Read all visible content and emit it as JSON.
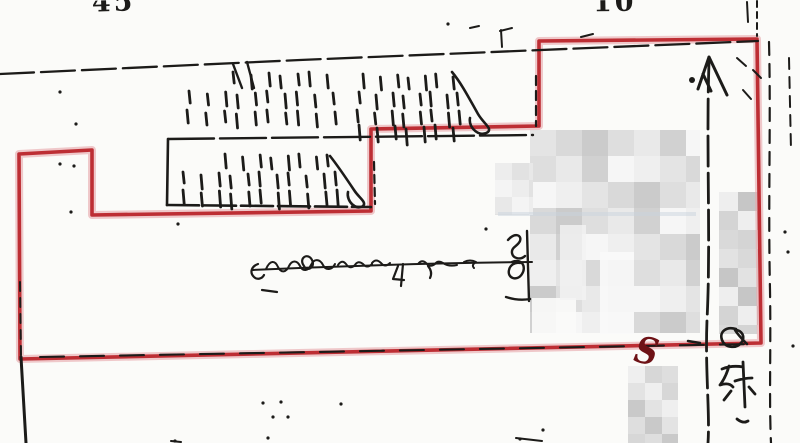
{
  "labels": {
    "top_left_partial": "45",
    "top_center_partial": "10",
    "boundary_s_mark": "S"
  },
  "colors": {
    "paper": "#fbfbf9",
    "ink": "#1c1b19",
    "boundary": "#b82127",
    "boundary_halo": "#e8a7aa",
    "annotation_red": "#6e1216"
  },
  "drawing": {
    "red_boundary": "19,154 92,150 92,215 371,211 371,129 539,126 539,41 757,39 761,343 20,359",
    "ink_lines": [
      {
        "pts": "0,74 300,60 758,41",
        "w": 2.3,
        "dash": "34 7",
        "n": "street-line-top"
      },
      {
        "pts": "168,139 533,135",
        "w": 2.4,
        "dash": "46 6",
        "n": "parcel-line"
      },
      {
        "pts": "168,139 167,205",
        "w": 2.6,
        "n": "parcel-line"
      },
      {
        "pts": "167,205 371,207",
        "w": 2.6,
        "dash": "32 5",
        "n": "parcel-line"
      },
      {
        "pts": "21,357 26,443",
        "w": 3,
        "n": "boundary-line-left-lower"
      },
      {
        "pts": "20,282 21,356",
        "w": 2,
        "dash": "9 7",
        "n": "ink-overlay"
      },
      {
        "pts": "40,357 752,344",
        "w": 2.1,
        "dash": "24 16",
        "n": "ink-overlay"
      },
      {
        "d": "M709,62 C706,150 711,240 707,320 C705,370 710,412 708,443",
        "w": 2.8,
        "dash": "30 7",
        "n": "road-line"
      },
      {
        "d": "M769,42 C771,120 768,200 770,290 C771,350 769,400 771,443",
        "w": 2.2,
        "dash": "13 9",
        "n": "road-line"
      },
      {
        "d": "M757,1 L757,36",
        "w": 2,
        "dash": "6 5",
        "n": "road-line"
      },
      {
        "d": "M747,2 L748,22",
        "w": 2,
        "n": "road-line"
      },
      {
        "d": "M789,58 L791,150",
        "w": 2,
        "dash": "11 8",
        "n": "road-line"
      },
      {
        "d": "M536,76 L536,126",
        "w": 2.2,
        "dash": "9 6",
        "n": "ink-overlay"
      },
      {
        "d": "M374,162 L375,204",
        "w": 2.2,
        "dash": "8 5",
        "n": "ink-overlay"
      },
      {
        "d": "M737,58 l9,8 M753,70 l8,8 M743,90 l8,9",
        "w": 2,
        "n": "scribble-marks"
      },
      {
        "d": "M688,341 l12,2",
        "w": 2.5,
        "n": "ink-overlay"
      },
      {
        "d": "M516,438 l26,3 M171,441 l10,1",
        "w": 2,
        "n": "edge-fragments"
      },
      {
        "d": "M500,31 l12,-3 M501,30 l1,17 M581,37 l12,-3 M470,28 l9,-2",
        "w": 2,
        "n": "tick-marks"
      }
    ],
    "paths": [
      {
        "d": "M709,57 L698,89 M709,57 L727,95 M703,74 L711,91",
        "w": 3,
        "n": "up-arrow-head"
      },
      {
        "d": "M252,270 C340,266 440,263 532,262",
        "w": 2,
        "n": "dimension-line"
      },
      {
        "d": "M258,264 c-6,2 -9,8 -4,13 c3,3 8,2 10,-2 M262,290 l15,2",
        "w": 2.2,
        "n": "dimension-left-tick"
      },
      {
        "d": "M266,269 c4,-9 9,-9 12,-2 c3,6 8,6 11,-1 c3,-6 8,-6 11,0 c3,6 8,5 11,-1 c3,-7 9,-6 12,0 c3,6 9,5 12,-1",
        "w": 2,
        "n": "dimension-text-scrawl"
      },
      {
        "d": "M304,266 c-6,-8 4,-14 8,-6 c4,8 -6,12 -8,6",
        "w": 2.2,
        "n": "dimension-text-scrawl"
      },
      {
        "d": "M338,265 q4,-6 8,-1 q4,6 9,1 q3,-5 8,-1 q4,5 9,0 M372,263 q4,-5 9,0 q4,5 9,0",
        "w": 2,
        "n": "dimension-text-scrawl"
      },
      {
        "d": "M398,266 l-5,13 l11,1 M403,264 l-2,22 M428,266 q5,6 2,12",
        "w": 2.2,
        "n": "dimension-text-scrawl"
      },
      {
        "d": "M418,264 q4,-5 8,-1 q4,5 9,1 q3,-4 8,-1 q6,4 14,2 M464,262 q6,-3 12,0 q-5,3 -2,6",
        "w": 2,
        "n": "dimension-text-scrawl"
      },
      {
        "d": "M508,240 c7,-8 14,-5 12,1 c-2,5 -9,6 -8,12 c1,6 9,7 13,3 M512,262 c9,-4 15,4 10,12 c-5,8 -15,4 -13,-4 c1,-5 6,-8 11,-7 M527,231 l2,70 M506,297 q12,4 24,2",
        "w": 2.4,
        "n": "dimension-end-mark"
      },
      {
        "d": "M452,72 c10,12 18,28 26,42 c6,10 14,14 10,18 c-8,6 -20,-4 -18,-14",
        "w": 2.6,
        "n": "hatch-flourish"
      },
      {
        "d": "M330,156 c8,10 16,22 24,34 c5,8 13,12 9,16 c-7,5 -17,-5 -15,-14",
        "w": 2.6,
        "n": "hatch-flourish"
      },
      {
        "d": "M233,64 l9,24 M247,62 l7,26",
        "w": 2.4,
        "n": "hatch-stroke"
      },
      {
        "d": "M722,369 q10,-4 21,-2 M729,366 q-3,11 -9,19 q9,-3 13,2 M743,362 l2,45 M735,381 q9,-3 17,-3 M731,391 l-7,9 M749,387 l6,7 M737,419 q6,5 11,2",
        "w": 2.8,
        "n": "kanji-annotation"
      },
      {
        "d": "M736,329 c-10,-3 -17,3 -14,11 c3,8 14,9 19,3 c5,-6 1,-13 -6,-13 c3,5 8,10 12,14",
        "w": 2.6,
        "n": "loop-annotation"
      }
    ],
    "hatch_rows": [
      {
        "y": 74,
        "x0": 236,
        "x1": 326,
        "n": 7
      },
      {
        "y": 93,
        "x0": 192,
        "x1": 330,
        "n": 10
      },
      {
        "y": 112,
        "x0": 190,
        "x1": 332,
        "n": 10
      },
      {
        "y": 76,
        "x0": 366,
        "x1": 452,
        "n": 7
      },
      {
        "y": 94,
        "x0": 362,
        "x1": 460,
        "n": 8
      },
      {
        "y": 112,
        "x0": 360,
        "x1": 462,
        "n": 8
      },
      {
        "y": 127,
        "x0": 362,
        "x1": 452,
        "n": 7,
        "h": 13
      },
      {
        "y": 156,
        "x0": 228,
        "x1": 330,
        "n": 8
      },
      {
        "y": 174,
        "x0": 186,
        "x1": 336,
        "n": 11
      },
      {
        "y": 192,
        "x0": 186,
        "x1": 338,
        "n": 11,
        "h": 13
      }
    ],
    "mosaics": [
      {
        "x": 530,
        "y": 130,
        "w": 170,
        "h": 203,
        "cell": 26,
        "seed": 2,
        "shades": [
          "#cbcbcb",
          "#d9d9d9",
          "#e4e4e4",
          "#efefef",
          "#f6f6f6",
          "#d1d1d1",
          "#e9e9e9",
          "#dedede"
        ]
      },
      {
        "x": 495,
        "y": 163,
        "w": 38,
        "h": 52,
        "cell": 17,
        "seed": 1,
        "shades": [
          "#e2e2e2",
          "#ededed",
          "#f4f4f4",
          "#e8e8e8"
        ]
      },
      {
        "x": 719,
        "y": 192,
        "w": 39,
        "h": 142,
        "cell": 19,
        "seed": 3,
        "shades": [
          "#c6c6c6",
          "#d4d4d4",
          "#e2e2e2",
          "#eeeeee",
          "#d9d9d9"
        ]
      },
      {
        "x": 628,
        "y": 366,
        "w": 50,
        "h": 77,
        "cell": 17,
        "seed": 4,
        "shades": [
          "#c9c9c9",
          "#d7d7d7",
          "#e3e3e3",
          "#dedede",
          "#efefef"
        ]
      }
    ],
    "patches": [
      {
        "x": 600,
        "y": 252,
        "w": 34,
        "h": 82,
        "c": "#fafafa",
        "o": 0.9
      },
      {
        "x": 532,
        "y": 298,
        "w": 44,
        "h": 36,
        "c": "#fbfbfa",
        "o": 0.9
      },
      {
        "x": 560,
        "y": 225,
        "w": 26,
        "h": 75,
        "c": "#f2f2f2",
        "o": 0.8
      },
      {
        "x": 498,
        "y": 212,
        "w": 198,
        "h": 4,
        "c": "#c9d4de",
        "o": 0.5
      }
    ],
    "specks": [
      [
        60,
        92
      ],
      [
        76,
        124
      ],
      [
        60,
        164
      ],
      [
        74,
        166
      ],
      [
        71,
        212
      ],
      [
        178,
        224
      ],
      [
        486,
        229
      ],
      [
        263,
        403
      ],
      [
        281,
        402
      ],
      [
        273,
        417
      ],
      [
        288,
        417
      ],
      [
        341,
        404
      ],
      [
        175,
        441
      ],
      [
        268,
        438
      ],
      [
        520,
        439
      ],
      [
        543,
        430
      ],
      [
        785,
        232
      ],
      [
        788,
        252
      ],
      [
        793,
        346
      ],
      [
        692,
        80,
        3
      ],
      [
        448,
        24
      ]
    ]
  }
}
